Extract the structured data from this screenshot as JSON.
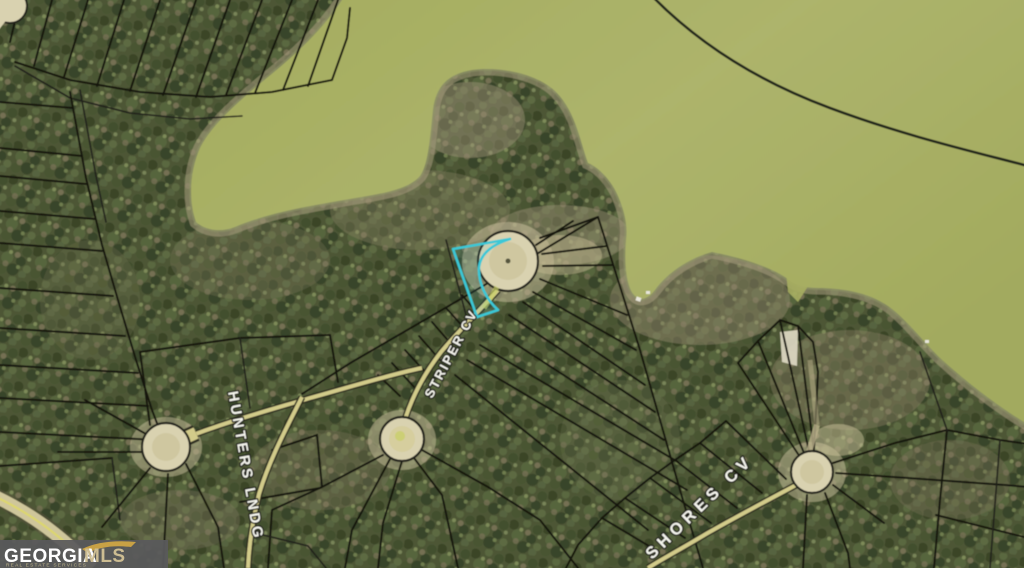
{
  "meta": {
    "description": "Aerial GIS plat map of lakefront subdivision lots with one lot outlined in cyan",
    "width": 1024,
    "height": 568
  },
  "map": {
    "road_labels": [
      {
        "id": "striper-cv",
        "text": "STRIPER CV"
      },
      {
        "id": "hunters-lndg",
        "text": "HUNTERS LNDG"
      },
      {
        "id": "shores-cv",
        "text": "SHORES CV"
      }
    ],
    "highlight": {
      "color": "#3bc8d6",
      "description": "subject lot outline beside cul-de-sac"
    },
    "colors": {
      "water": "#a9b065",
      "forest": "#4d5636",
      "parcel_line": "#181810",
      "road_fill": "#d2cb8a",
      "culdesac_fill": "#d9d2b0",
      "shore_fringe": "#a89d7d"
    },
    "watermark": {
      "brand": "GEORGIA",
      "brand_suffix": "MLS",
      "tagline": "REAL ESTATE SERVICES"
    }
  }
}
